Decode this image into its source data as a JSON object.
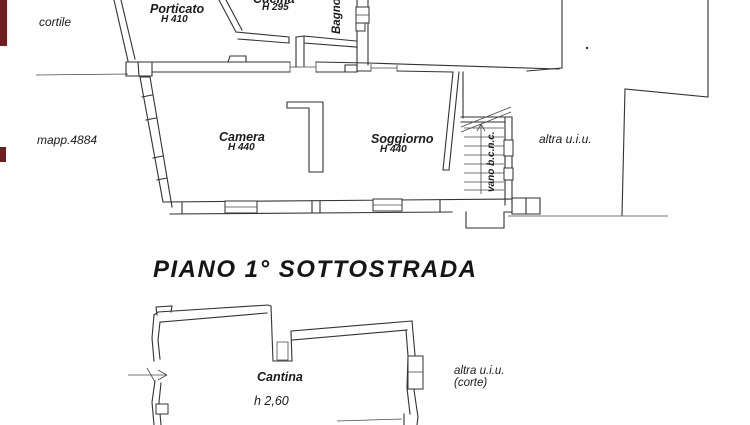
{
  "colors": {
    "ink": "#333333",
    "paper": "#fefefe",
    "edge_artifact": "#6f1f1f"
  },
  "title": "PIANO 1° SOTTOSTRADA",
  "upper_plan": {
    "cortile": "cortile",
    "mapp": "mapp.4884",
    "altra_uiu": "altra u.i.u.",
    "porticato": {
      "name": "Porticato",
      "h": "H 410"
    },
    "cucina": {
      "name": "Cucina",
      "h": "H 295"
    },
    "bagno": "Bagno",
    "camera": {
      "name": "Camera",
      "h": "H 440"
    },
    "soggiorno": {
      "name": "Soggiorno",
      "h": "H 440"
    },
    "vano": "vano b.c.n.c."
  },
  "lower_plan": {
    "cantina": {
      "name": "Cantina",
      "h": "h 2,60"
    },
    "altra_uiu": "altra u.i.u.",
    "corte": "(corte)"
  }
}
